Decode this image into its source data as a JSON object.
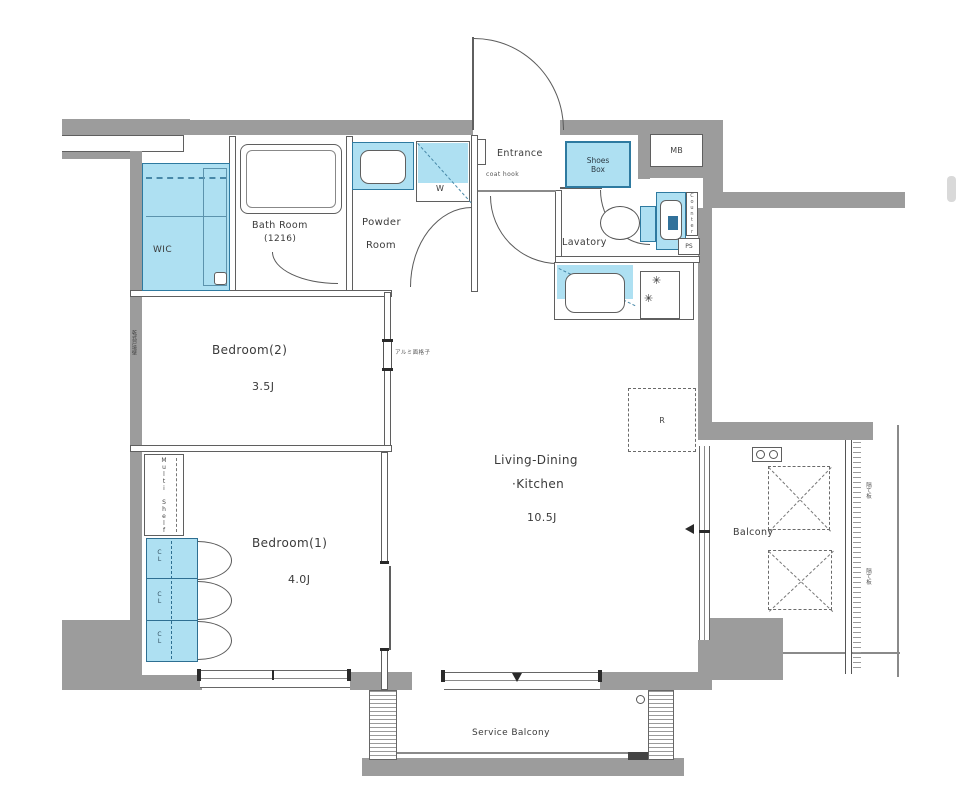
{
  "colors": {
    "wall_gray": "#9c9c9c",
    "fixture_fill": "#aee0f2",
    "fixture_border": "#2e7aa0",
    "line": "#5f5f5f"
  },
  "rooms": {
    "entrance": {
      "label": "Entrance"
    },
    "bath": {
      "label": "Bath Room",
      "size": "(1216)"
    },
    "powder": {
      "label_line1": "Powder",
      "label_line2": "Room"
    },
    "lavatory": {
      "label": "Lavatory"
    },
    "wic": {
      "label": "WIC"
    },
    "bedroom2": {
      "label": "Bedroom(2)",
      "size": "3.5J"
    },
    "bedroom1": {
      "label": "Bedroom(1)",
      "size": "4.0J"
    },
    "ldk": {
      "label_line1": "Living-Dining",
      "label_line2": "·Kitchen",
      "size": "10.5J"
    },
    "balcony": {
      "label": "Balcony"
    },
    "service_balcony": {
      "label": "Service Balcony"
    }
  },
  "fixtures": {
    "shoes_box": {
      "line1": "Shoes",
      "line2": "Box"
    },
    "meter_box": {
      "label": "MB"
    },
    "washer": {
      "label": "W"
    },
    "refrigerator": {
      "label": "R"
    },
    "pipe_space": {
      "label": "PS"
    },
    "counter": {
      "label": "Counter"
    },
    "multi_shelf": {
      "label": "Multi Shelf"
    },
    "closet": {
      "label": "CL"
    },
    "coat_hook": {
      "label": "coat hook"
    }
  },
  "annotations": {
    "interior_window": "アルミ面格子",
    "party_wall": "乾式戸境壁",
    "balcony_partition": "隔て板"
  },
  "icons": {
    "burner": "✳"
  }
}
